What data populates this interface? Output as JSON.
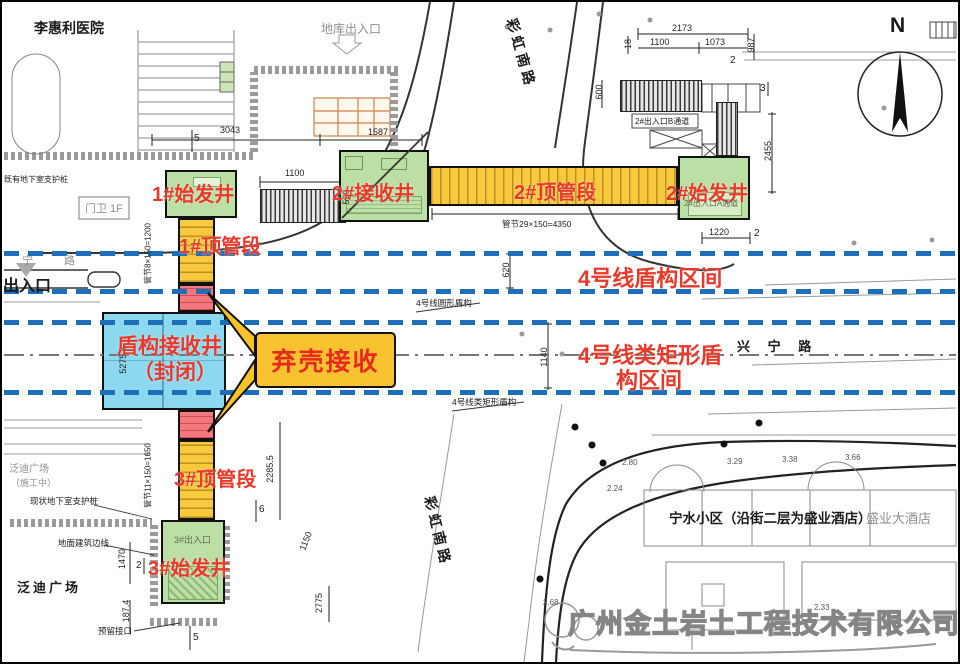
{
  "drawing": {
    "hospital": "李惠利医院",
    "garage_exit": "地库出入口",
    "gate": "门卫 1F",
    "entrance": "出入口",
    "ning_road": "宁  路",
    "support_piles_top": "既有地下室支护桩",
    "caihong_road_top": "彩虹南路",
    "caihong_road_bottom": "彩虹南路",
    "xingning_road": "兴 宁 路",
    "compass": "N"
  },
  "shafts": {
    "s1": "1#始发井",
    "p1": "1#顶管段",
    "s2r": "2#接收井",
    "p2": "2#顶管段",
    "s2s": "2#始发井",
    "p3": "3#顶管段",
    "s3": "3#始发井",
    "shield_l1": "盾构接收井",
    "shield_l2": "（封闭）",
    "callout": "弃壳接收",
    "exit_b": "2#出入口B通道",
    "exit_a": "2#出入口A通道",
    "exit_3": "3#出入口"
  },
  "tunnels": {
    "shield_zone": "4号线盾构区间",
    "rect_zone_l1": "4号线类矩形盾",
    "rect_zone_l2": "构区间",
    "round_tag": "4号线圆形盾构",
    "rect_tag": "4号线类矩形盾构"
  },
  "south": {
    "fandi": "泛迪广场",
    "fandi_gray": "泛迪广场",
    "under_constr": "（施工中）",
    "basement_piles": "现状地下室支护桩",
    "building_line": "地面建筑边线",
    "reserved": "预留接口",
    "ningshui": "宁水小区（沿街二层为盛业酒店）",
    "hotel": "盛业大酒店"
  },
  "dims": {
    "d3043": "3043",
    "d1587": "1587",
    "d1100a": "1100",
    "d520": "520",
    "d2173": "2173",
    "d1100b": "1100",
    "d1073": "1073",
    "d987": "987",
    "d18": "18",
    "d600": "600",
    "d2455": "2455",
    "d1220": "1220",
    "d620": "620",
    "d1140": "1140",
    "d5275": "5275.5",
    "d2285": "2285.5",
    "d1470": "1470",
    "d1874": "187.4",
    "d2775": "2775",
    "d1150": "1150",
    "seg1": "管节8×150=1200",
    "seg2": "管节29×150=4350",
    "seg3": "管节11×150=1650",
    "t5a": "5",
    "t2a": "2",
    "t3a": "3",
    "t2b": "2",
    "t6a": "6",
    "t2c": "2",
    "t5b": "5"
  },
  "elev": {
    "e280": "2.80",
    "e224": "2.24",
    "e268": "2.68",
    "e329": "3.29",
    "e338": "3.38",
    "e366": "3.66",
    "e233": "2.33"
  },
  "watermark": "广州金土岩土工程技术有限公司",
  "colors": {
    "red_label": "#e8392b",
    "pipe_yellow": "#f8c83d",
    "shaft_green": "#bcdfa6",
    "shield_cyan": "#8bd8ef",
    "abandon_red": "#f3787e",
    "tunnel_blue": "#1e6fba",
    "callout_yellow": "#f8c230"
  }
}
